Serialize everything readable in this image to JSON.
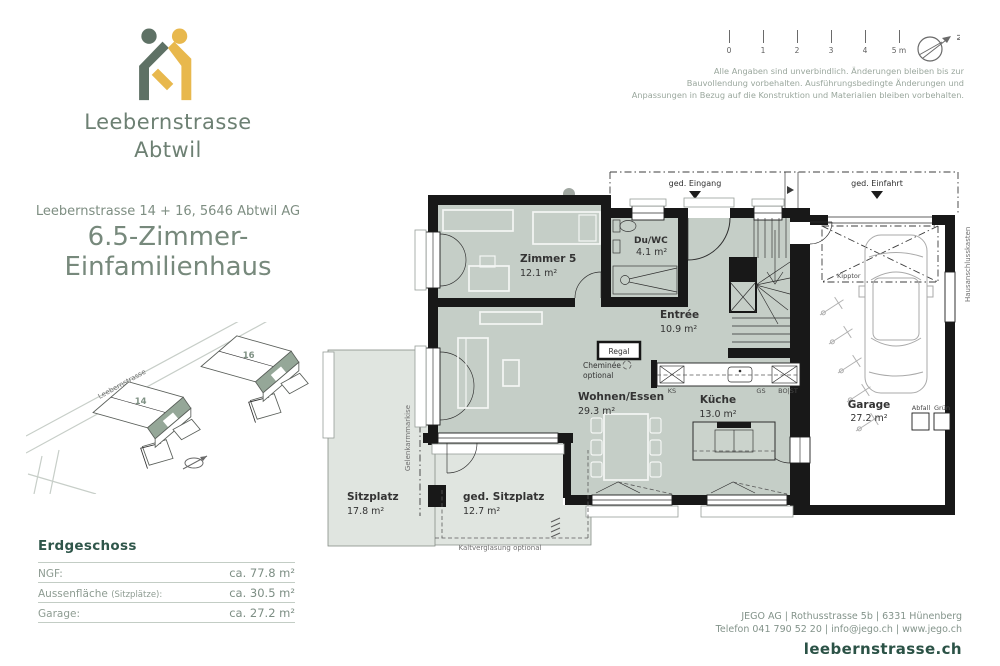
{
  "brand": {
    "line1": "Leebernstrasse",
    "line2": "Abtwil"
  },
  "header": {
    "north_label": "N"
  },
  "scalebar": {
    "ticks": [
      "0",
      "1",
      "2",
      "3",
      "4",
      "5 m"
    ]
  },
  "disclaimer": {
    "lines": [
      "Alle Angaben sind unverbindlich. Änderungen bleiben bis zur",
      "Bauvollendung vorbehalten. Ausführungsbedingte Änderungen und",
      "Anpassungen in Bezug auf die Konstruktion und Materialien bleiben vorbehalten."
    ]
  },
  "project": {
    "address": "Leebernstrasse 14 + 16, 5646 Abtwil AG",
    "title1": "6.5-Zimmer-",
    "title2": "Einfamilienhaus"
  },
  "siteplan": {
    "street": "Leebernstrasse",
    "house14": "14",
    "house16": "16"
  },
  "floor": {
    "heading": "Erdgeschoss",
    "rows": [
      {
        "label": "NGF:",
        "note": "",
        "value": "ca. 77.8 m²"
      },
      {
        "label": "Aussenfläche",
        "note": "(Sitzplätze):",
        "value": "ca. 30.5 m²"
      },
      {
        "label": "Garage:",
        "note": "",
        "value": "ca. 27.2 m²"
      }
    ]
  },
  "plan": {
    "rooms": {
      "zimmer5": {
        "name": "Zimmer 5",
        "area": "12.1 m²"
      },
      "duwc": {
        "name": "Du/WC",
        "area": "4.1 m²"
      },
      "entree": {
        "name": "Entrée",
        "area": "10.9 m²"
      },
      "wohnen": {
        "name": "Wohnen/Essen",
        "area": "29.3 m²"
      },
      "kueche": {
        "name": "Küche",
        "area": "13.0 m²"
      },
      "garage": {
        "name": "Garage",
        "area": "27.2 m²"
      },
      "sitzplatz": {
        "name": "Sitzplatz",
        "area": "17.8 m²"
      },
      "ged_sitzplatz": {
        "name": "ged. Sitzplatz",
        "area": "12.7 m²"
      }
    },
    "labels": {
      "ged_eingang": "ged. Eingang",
      "ged_einfahrt": "ged. Einfahrt",
      "hak": "Hausanschlusskasten",
      "kipptor": "Kipptor",
      "regal": "Regal",
      "cheminee": "Cheminée",
      "cheminee_opt": "optional",
      "kaltverglasung": "Kaltverglasung optional",
      "markise": "Gelenkarmmarkise",
      "ks": "KS",
      "gs": "GS",
      "bost": "BO|ST",
      "abfall": "Abfall",
      "gruen": "Grün"
    }
  },
  "footer": {
    "line1": "JEGO AG | Rothusstrasse 5b | 6331 Hünenberg",
    "line2": "Telefon 041 790 52 20 | info@jego.ch | www.jego.ch",
    "website": "leebernstrasse.ch"
  },
  "colors": {
    "brand_green": "#5e7165",
    "brand_yellow": "#e8b84d",
    "heading_green": "#2f564a",
    "text_green": "#83938a",
    "room_fill": "#c5cec7",
    "outdoor_fill": "#e0e5e0",
    "wall": "#181818"
  }
}
